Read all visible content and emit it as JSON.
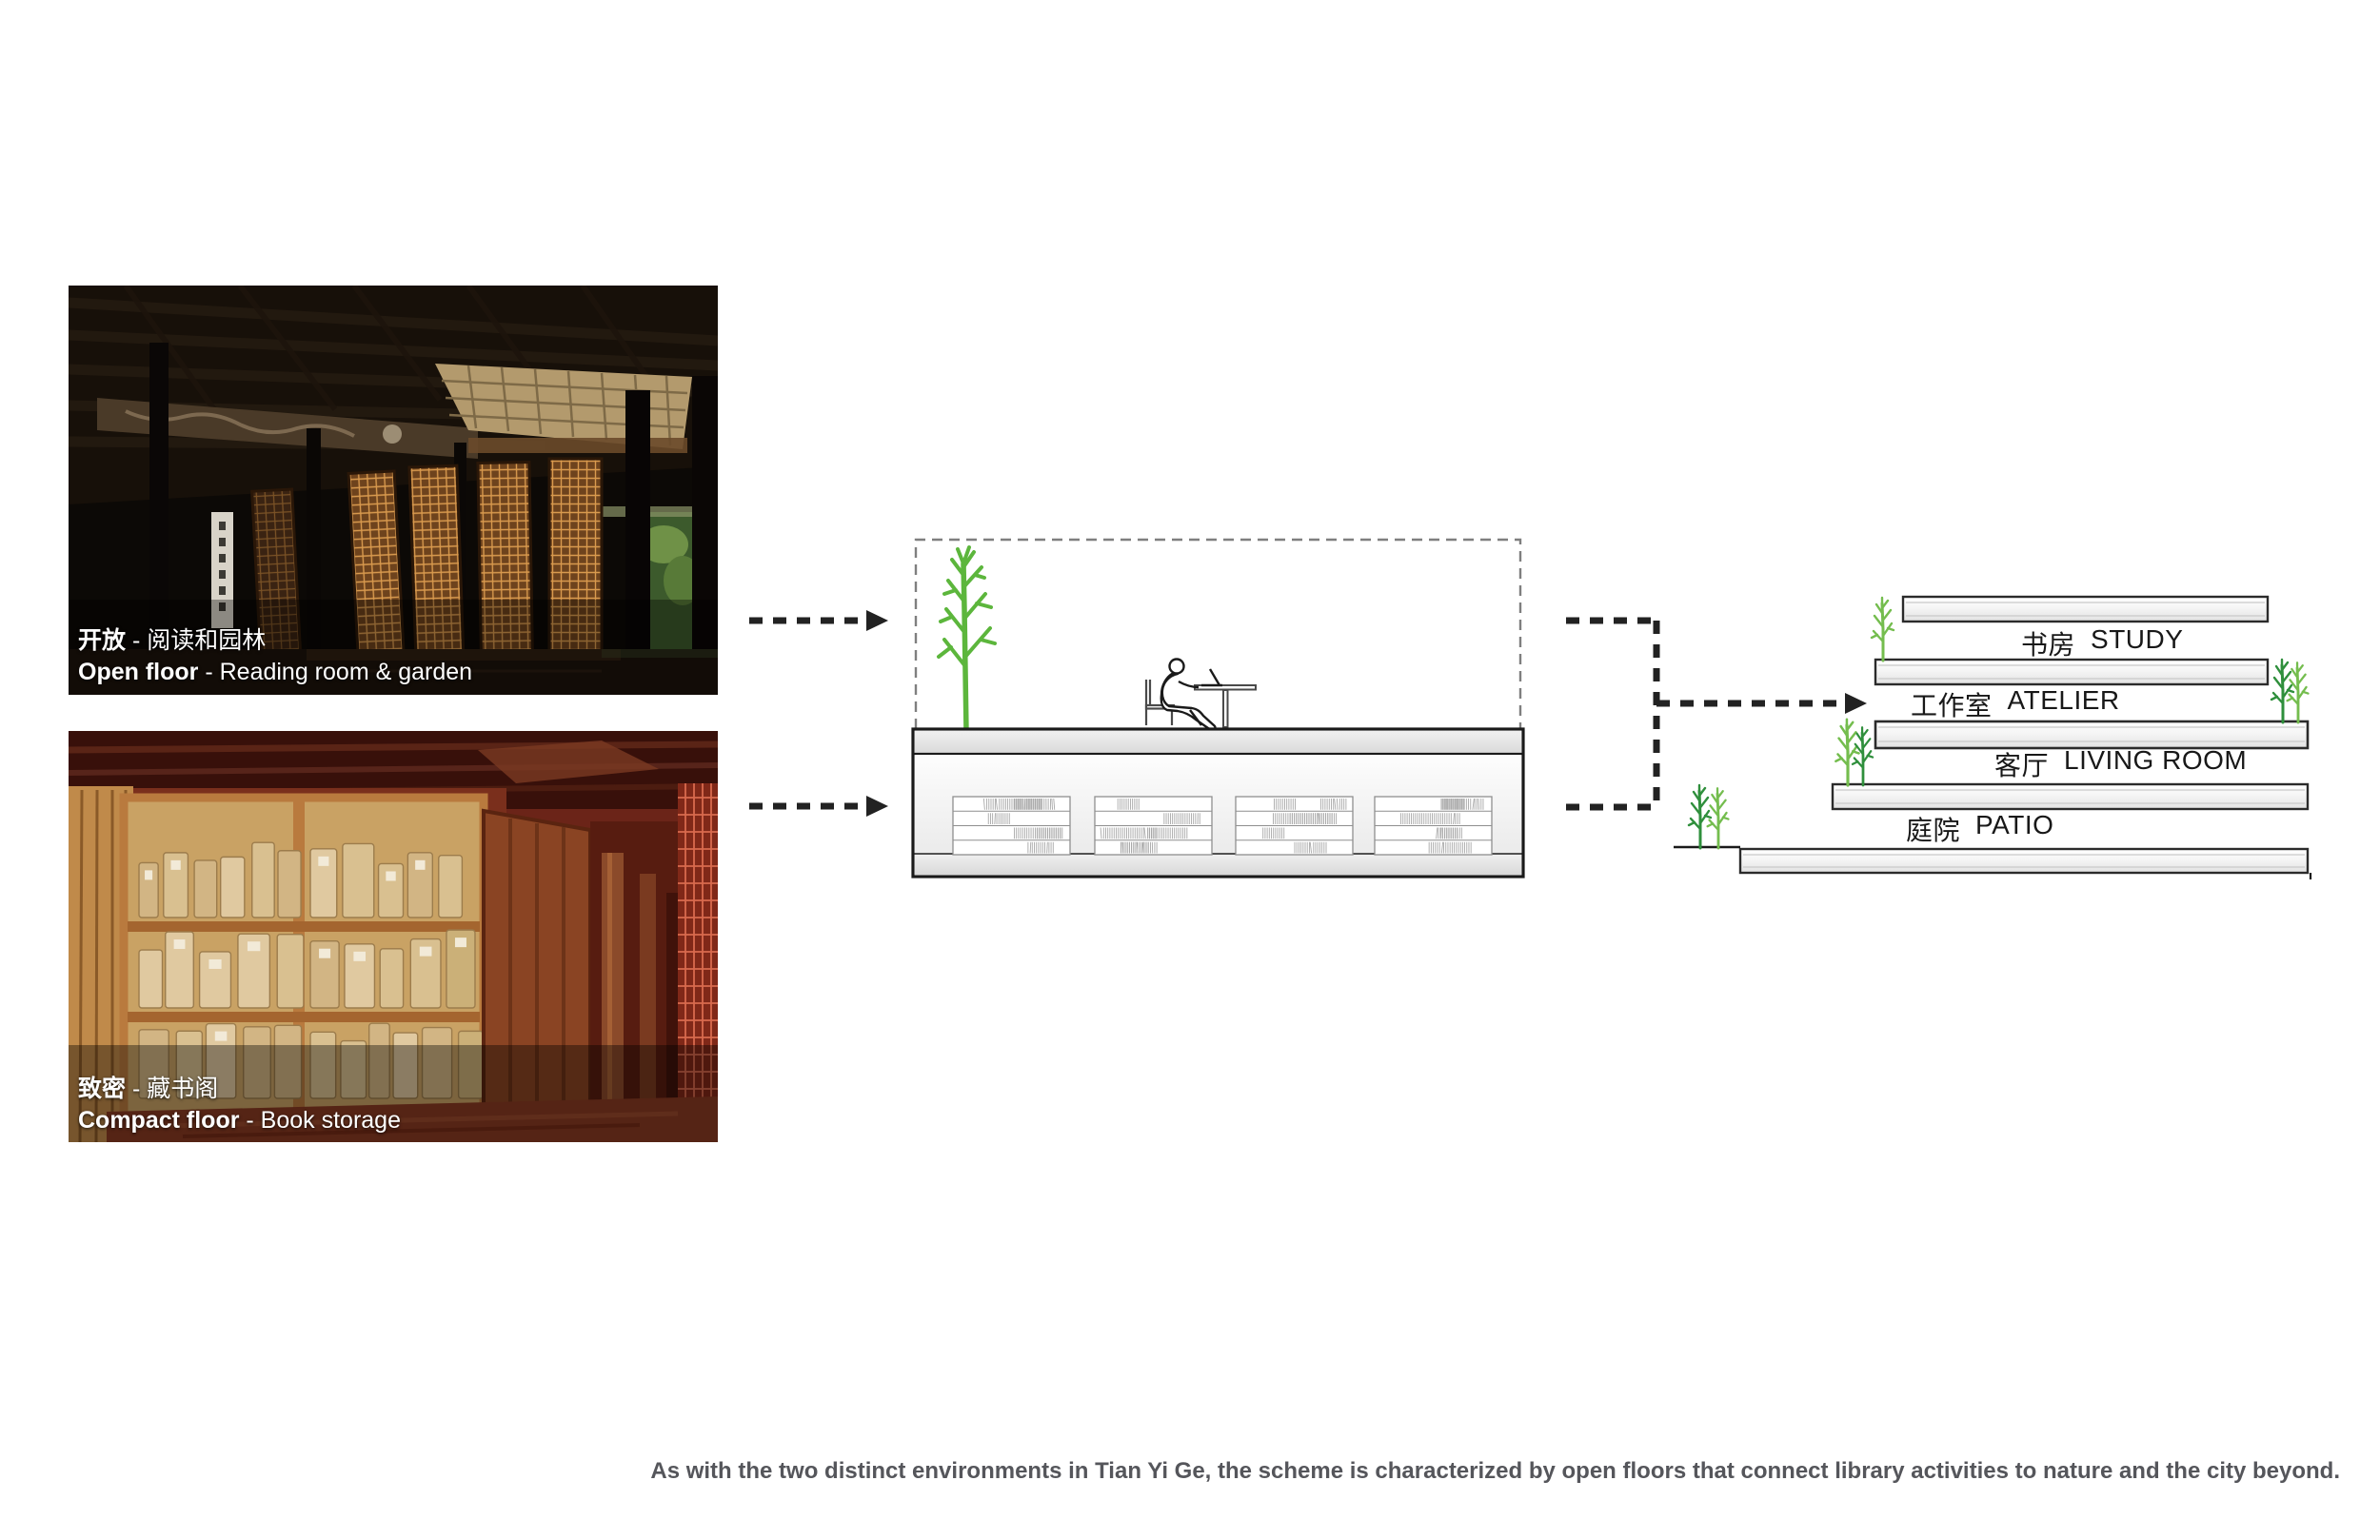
{
  "photos": [
    {
      "zh_bold": "开放",
      "zh_rest": " - 阅读和园林",
      "en_bold": "Open floor",
      "en_rest": " - Reading room & garden"
    },
    {
      "zh_bold": "致密",
      "zh_rest": " - 藏书阁",
      "en_bold": "Compact floor",
      "en_rest": " - Book storage"
    }
  ],
  "stacked": {
    "levels": [
      {
        "zh": "书房",
        "en": "STUDY"
      },
      {
        "zh": "工作室",
        "en": "ATELIER"
      },
      {
        "zh": "客厅",
        "en": "LIVING ROOM"
      },
      {
        "zh": "庭院",
        "en": "PATIO"
      }
    ]
  },
  "footer": {
    "text": "As with the two distinct environments in Tian Yi Ge, the scheme is characterized by open floors that connect library activities to nature and the city beyond."
  },
  "colors": {
    "tree_green": "#5cb63c",
    "tree_green_dark": "#2f8f3c",
    "tree_green_light": "#74bd4e",
    "arrow_black": "#222222",
    "slab_border": "#2b2b2b",
    "footer_gray": "#55565b",
    "caption_white": "#ffffff"
  }
}
